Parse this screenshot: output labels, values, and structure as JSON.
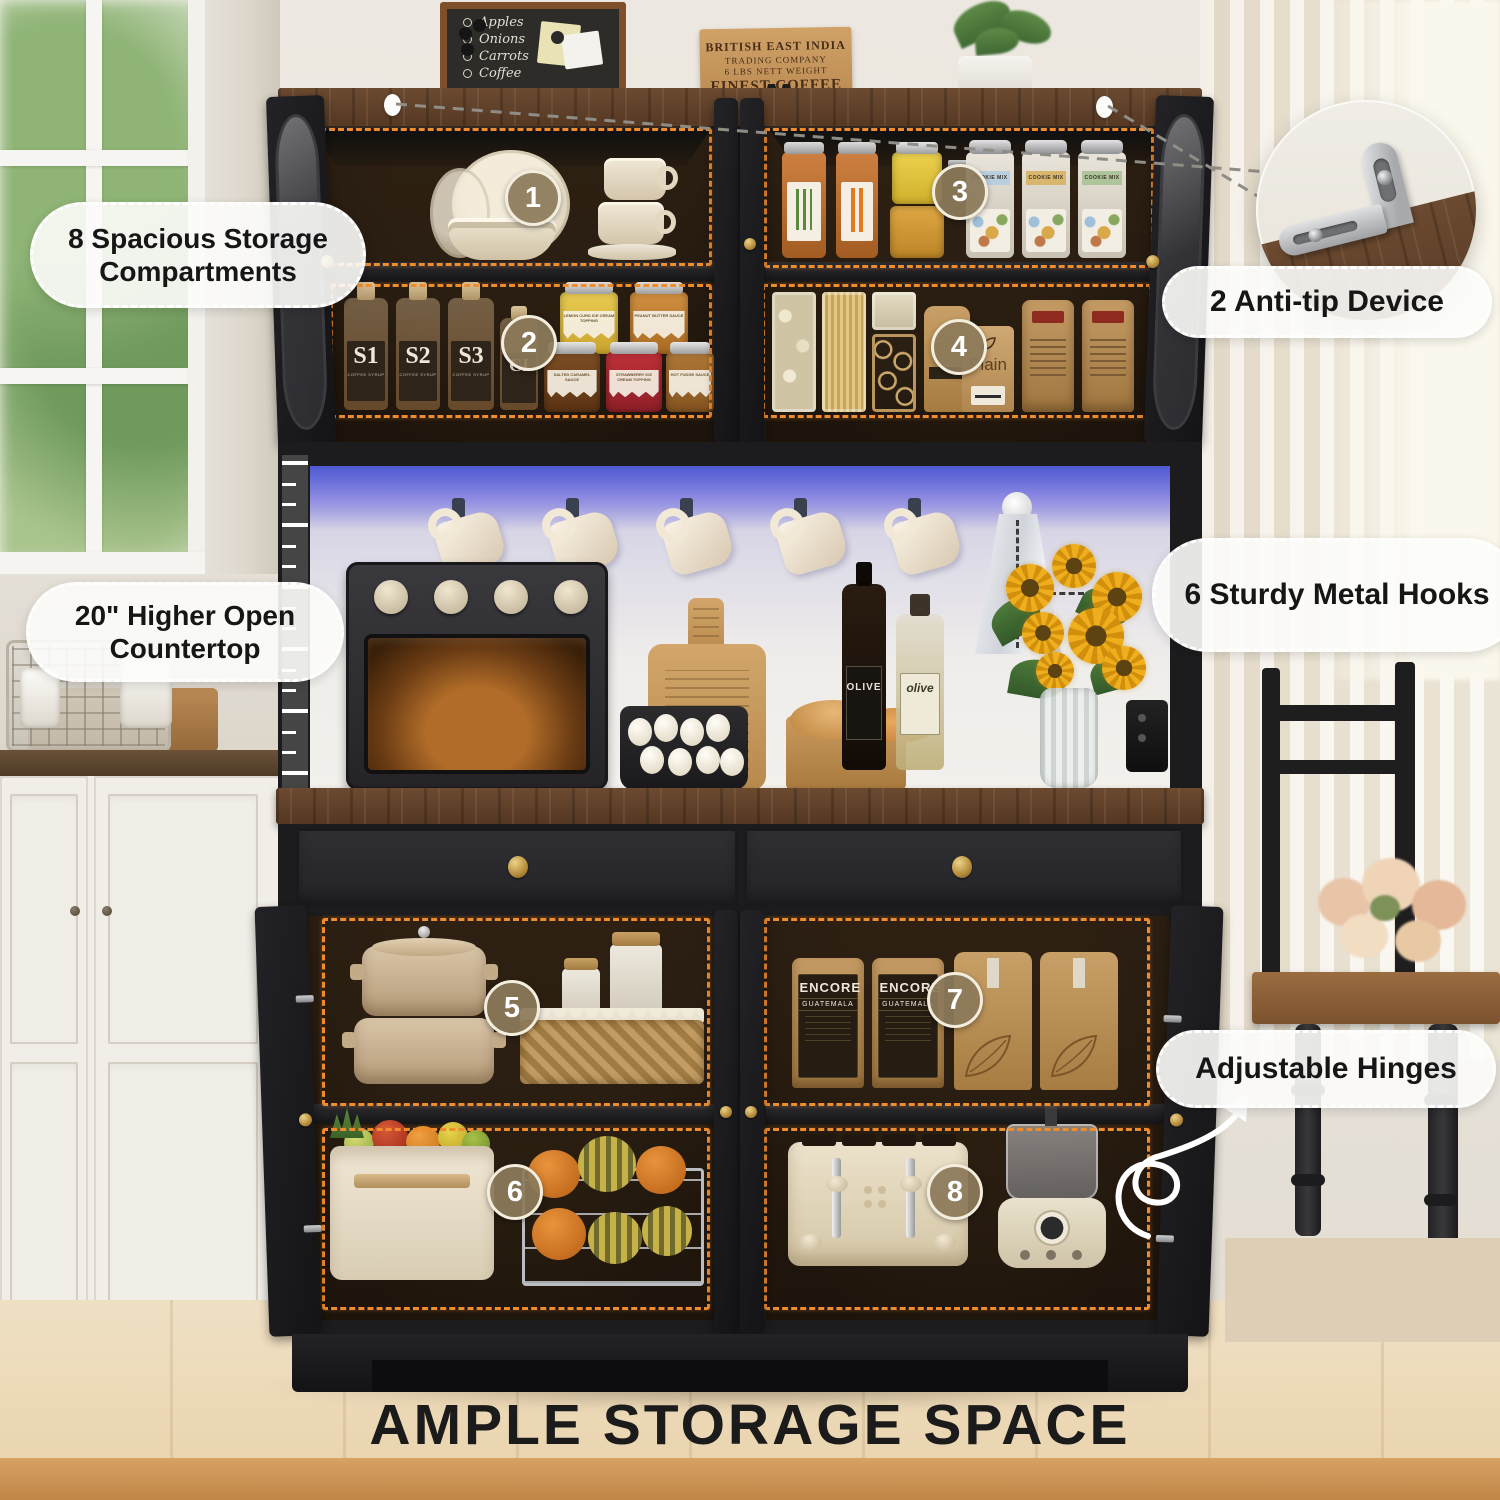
{
  "title": "AMPLE STORAGE SPACE",
  "callouts": {
    "compartments": "8 Spacious Storage Compartments",
    "anti_tip": "2 Anti-tip Device",
    "countertop": "20\" Higher Open Countertop",
    "hooks": "6 Sturdy Metal Hooks",
    "hinges": "Adjustable Hinges"
  },
  "badges": [
    "1",
    "2",
    "3",
    "4",
    "5",
    "6",
    "7",
    "8"
  ],
  "chalkboard": [
    "Apples",
    "Onions",
    "Carrots",
    "Coffee"
  ],
  "coffee_sign": [
    "BRITISH EAST INDIA",
    "TRADING COMPANY",
    "6 LBS NETT WEIGHT",
    "FINEST COFFEE"
  ],
  "bottles": {
    "syrups": [
      "S1",
      "S2",
      "S3"
    ],
    "syrup_type": "COFFEE SYRUP",
    "cocoa": "CI",
    "oil_dark": "OLIVE",
    "oil_light": "olive"
  },
  "jars": [
    "LEMON CURD ICE CREAM TOPPING",
    "PEANUT BUTTER SAUCE",
    "SALTED CARAMEL SAUCE",
    "STRAWBERRY ICE CREAM TOPPING",
    "HOT FUDGE SAUCE"
  ],
  "canister_label": "COOKIE MIX",
  "coffee_bags": {
    "brand": "ENCORE",
    "origin": "GUATEMALA"
  },
  "kraft_bag": "Plain",
  "colors": {
    "dashed_outline": "#ee8a2e",
    "led_glow": "#5661d8",
    "badge_fill": "#8d7b5c",
    "wood_top": "#5d3f2b",
    "accent_gold": "#c9a24e"
  }
}
